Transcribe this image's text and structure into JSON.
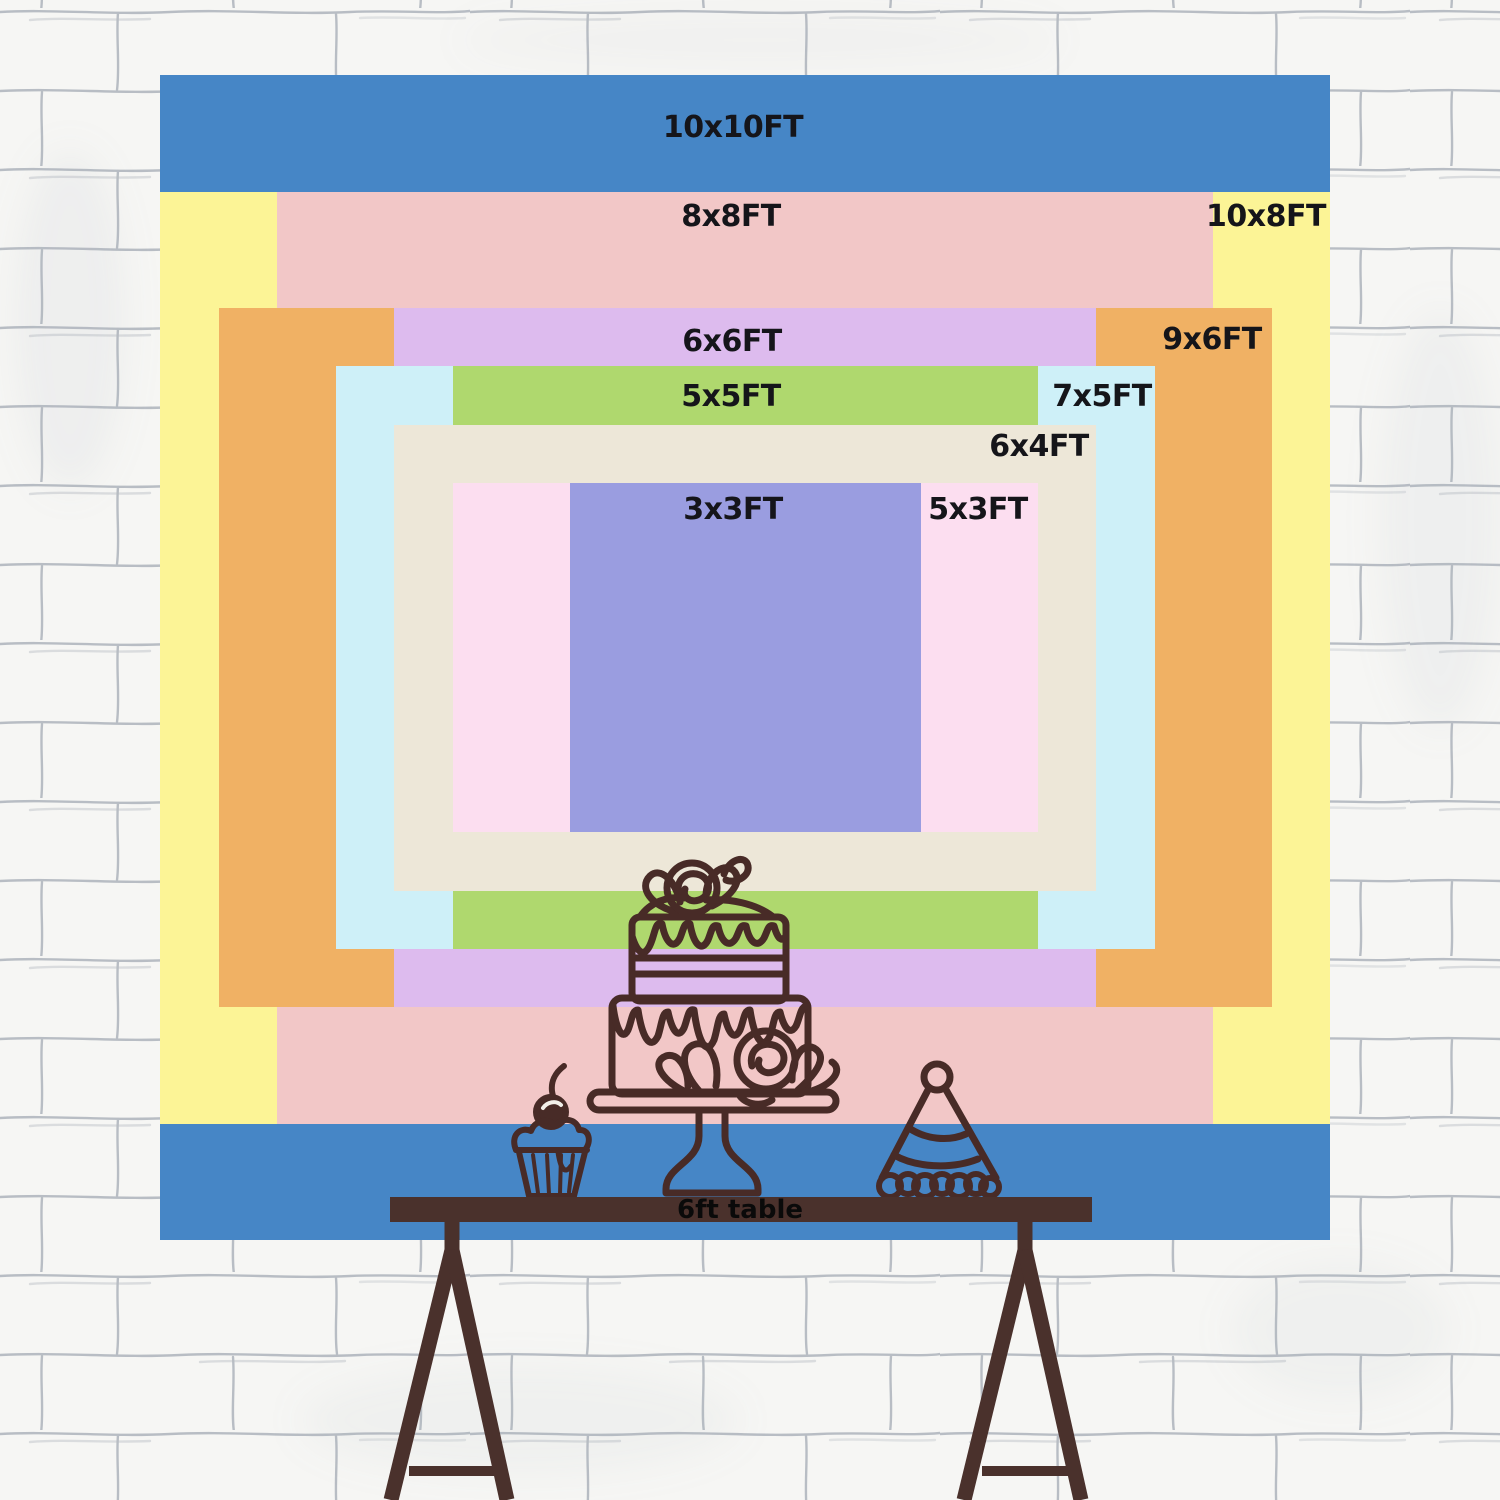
{
  "title": "Backdrop size comparison chart",
  "labels_color": "#15151a",
  "wall": {
    "base_color": "#f6f6f4",
    "mortar_color": "#8f98a3"
  },
  "sizes": [
    {
      "id": "10x10ft",
      "label": "10x10FT",
      "color": "#4686C6"
    },
    {
      "id": "10x8ft",
      "label": "10x8FT",
      "color": "#FCF496"
    },
    {
      "id": "8x8ft",
      "label": "8x8FT",
      "color": "#F2C7C7"
    },
    {
      "id": "9x6ft",
      "label": "9x6FT",
      "color": "#F0B164"
    },
    {
      "id": "6x6ft",
      "label": "6x6FT",
      "color": "#DDBBEE"
    },
    {
      "id": "7x5ft",
      "label": "7x5FT",
      "color": "#CEF0F8"
    },
    {
      "id": "5x5ft",
      "label": "5x5FT",
      "color": "#AFD86E"
    },
    {
      "id": "6x4ft",
      "label": "6x4FT",
      "color": "#EDE7D8"
    },
    {
      "id": "5x3ft",
      "label": "5x3FT",
      "color": "#FCDEF0"
    },
    {
      "id": "3x3ft",
      "label": "3x3FT",
      "color": "#9A9DE0"
    }
  ],
  "table": {
    "label": "6ft table",
    "label_color": "#0a0a0a",
    "color": "#4A312C"
  },
  "illustration": {
    "line_color": "#482B27",
    "items": [
      "cake-icon",
      "cupcake-icon",
      "party-hat-icon"
    ]
  }
}
